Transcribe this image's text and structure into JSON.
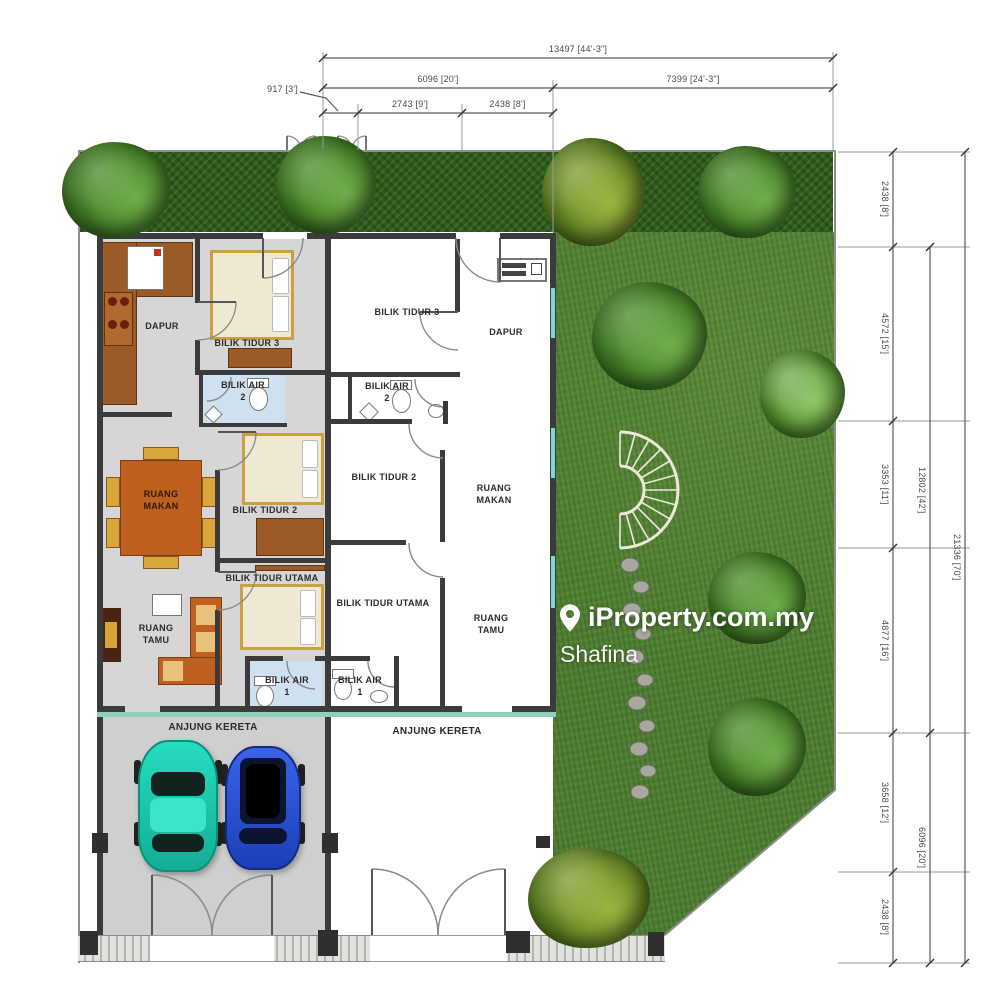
{
  "watermark": {
    "icon": "map-pin-icon",
    "brand": "iProperty.com.my",
    "agent": "Shafina"
  },
  "dimensions": {
    "top": {
      "total": "13497 [44'-3\"]",
      "left_span": "6096 [20']",
      "right_span": "7399 [24'-3\"]",
      "offset": "917 [3']",
      "gate1": "2743 [9']",
      "gate2": "2438 [8']"
    },
    "right": {
      "segments": [
        "2438 [8']",
        "4572 [15']",
        "3353 [11']",
        "4877 [16']",
        "3658 [12']",
        "2438 [8']"
      ],
      "mid_upper": "12802 [42']",
      "mid_lower": "6096 [20']",
      "total": "21336 [70']"
    }
  },
  "units": {
    "left": {
      "dapur": "DAPUR",
      "bilik_tidur_3": "BILIK TIDUR 3",
      "bilik_air_2_l1": "BILIK AIR",
      "bilik_air_2_l2": "2",
      "ruang_makan_l1": "RUANG",
      "ruang_makan_l2": "MAKAN",
      "bilik_tidur_2": "BILIK TIDUR 2",
      "bilik_tidur_utama": "BILIK TIDUR UTAMA",
      "ruang_tamu_l1": "RUANG",
      "ruang_tamu_l2": "TAMU",
      "bilik_air_1_l1": "BILIK AIR",
      "bilik_air_1_l2": "1",
      "anjung_kereta": "ANJUNG KERETA"
    },
    "right": {
      "bilik_tidur_3": "BILIK TIDUR 3",
      "dapur": "DAPUR",
      "bilik_air_2_l1": "BILIK AIR",
      "bilik_air_2_l2": "2",
      "bilik_tidur_2": "BILIK TIDUR 2",
      "ruang_makan_l1": "RUANG",
      "ruang_makan_l2": "MAKAN",
      "bilik_tidur_utama": "BILIK TIDUR UTAMA",
      "ruang_tamu_l1": "RUANG",
      "ruang_tamu_l2": "TAMU",
      "bilik_air_1_l1": "BILIK AIR",
      "bilik_air_1_l2": "1",
      "anjung_kereta": "ANJUNG KERETA"
    }
  },
  "colors": {
    "wall": "#3b3b3b",
    "floor_left_unit": "#d6d6d6",
    "floor_right_unit": "#ffffff",
    "bathroom_floor": "#cfe0f0",
    "window_accent": "#7fd8cf",
    "furniture_wood": "#9c5a26",
    "furniture_orange": "#c06020",
    "lawn": "#4d7c32",
    "hedge": "#2e5a1c",
    "car_teal": "#19cfb0",
    "car_blue": "#2453dd",
    "watermark_text": "#ffffff"
  }
}
